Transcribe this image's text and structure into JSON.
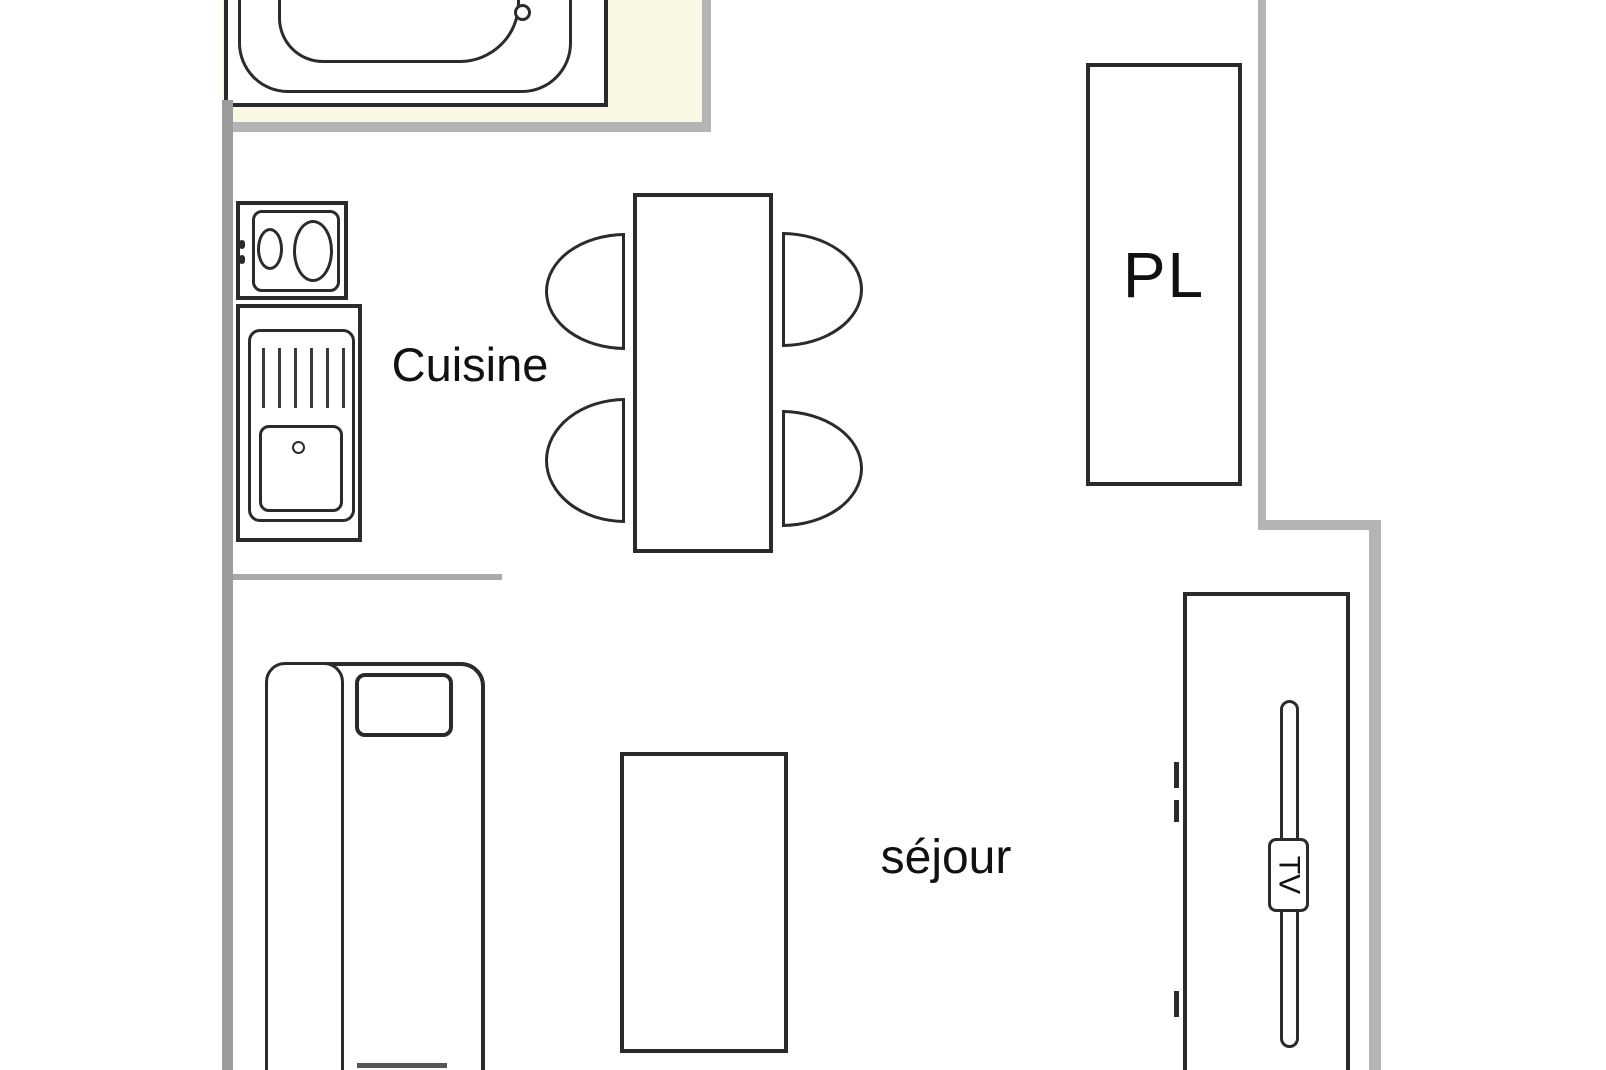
{
  "floorplan": {
    "labels": {
      "kitchen": "Cuisine",
      "living_room": "séjour",
      "closet": "PL",
      "tv": "TV"
    },
    "colors": {
      "background": "#ffffff",
      "bathroom_floor": "#faf7e4",
      "wall_dark": "#9c9c9c",
      "wall_mid": "#a9a9a9",
      "wall_light": "#b4b4b4",
      "outline": "#2b2b2b",
      "text": "#111111"
    }
  }
}
